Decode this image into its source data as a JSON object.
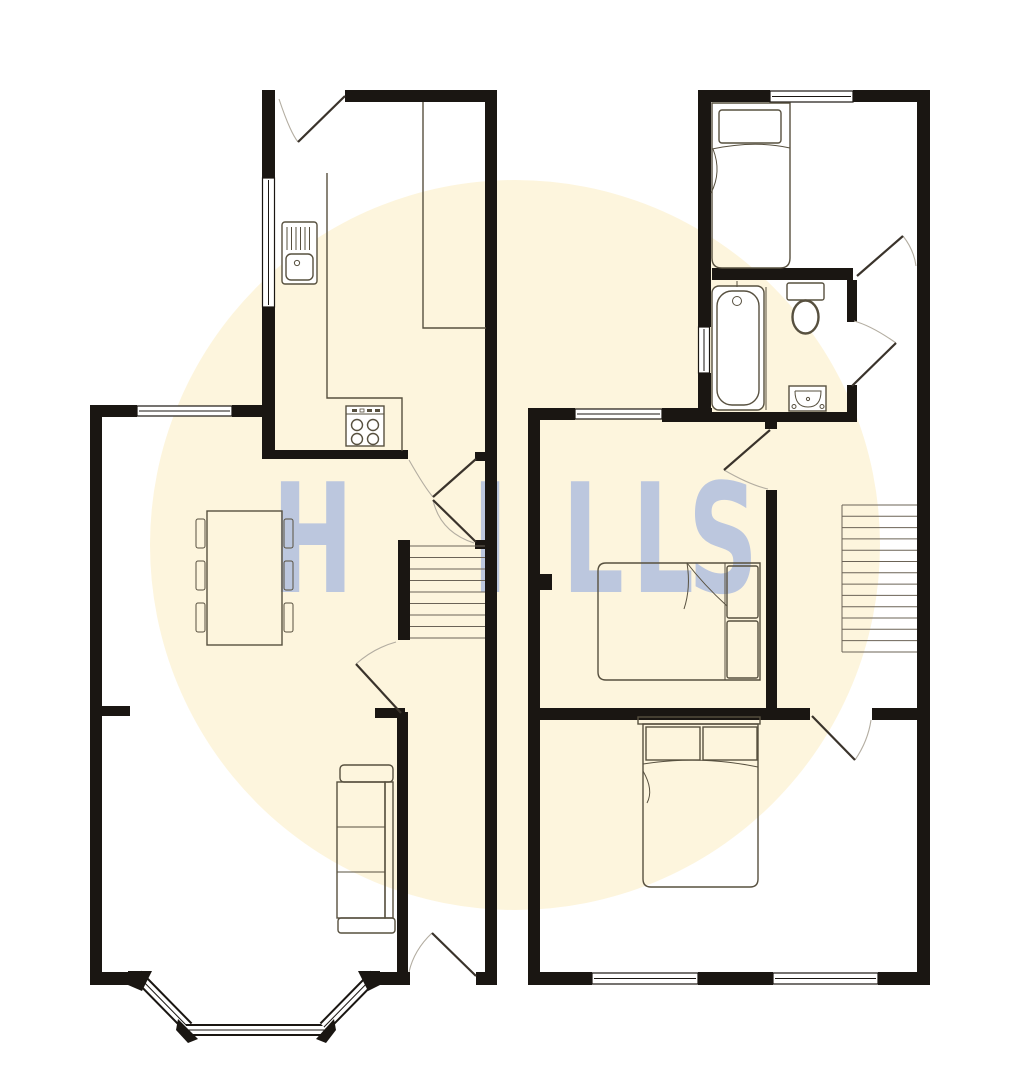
{
  "watermark": {
    "letters": [
      "H",
      "I",
      "L",
      "L",
      "S"
    ]
  },
  "colors": {
    "page": "#ffffff",
    "circle": "#fdf5dd",
    "wall": "#1a1612",
    "fixture": "#57503f",
    "leaf": "#3a332b",
    "arc": "#b3ada1",
    "wm": "#bcc7de"
  }
}
